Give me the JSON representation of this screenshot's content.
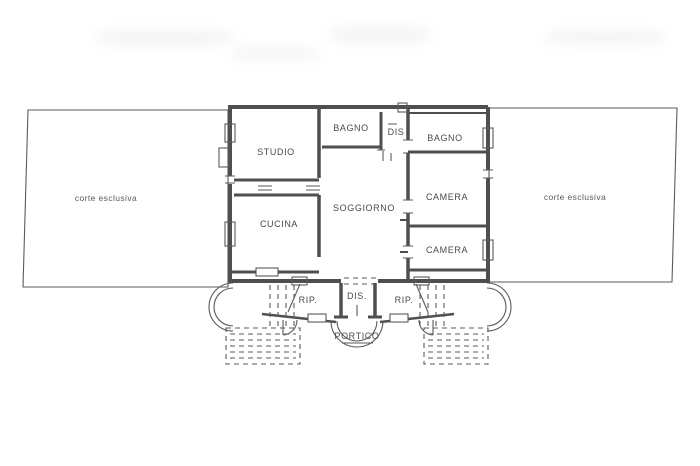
{
  "plan": {
    "type": "floor-plan",
    "language": "Italian",
    "rooms": [
      {
        "id": "studio",
        "label": "STUDIO"
      },
      {
        "id": "bagno-top",
        "label": "BAGNO"
      },
      {
        "id": "dis-top",
        "label": "DIS"
      },
      {
        "id": "bagno-right",
        "label": "BAGNO"
      },
      {
        "id": "soggiorno",
        "label": "SOGGIORNO"
      },
      {
        "id": "cucina",
        "label": "CUCINA"
      },
      {
        "id": "camera-mid",
        "label": "CAMERA"
      },
      {
        "id": "camera-low",
        "label": "CAMERA"
      },
      {
        "id": "rip-left",
        "label": "RIP."
      },
      {
        "id": "dis-bottom",
        "label": "DIS."
      },
      {
        "id": "rip-right",
        "label": "RIP."
      },
      {
        "id": "portico",
        "label": "PORTICO"
      }
    ],
    "courtyards": [
      {
        "id": "corte-left",
        "label": "corte esclusiva"
      },
      {
        "id": "corte-right",
        "label": "corte esclusiva"
      }
    ],
    "colors": {
      "background": "#ffffff",
      "wall_line": "#4f4f4f",
      "thin_line": "#5a5a5a",
      "text": "#4a4a4a"
    }
  }
}
